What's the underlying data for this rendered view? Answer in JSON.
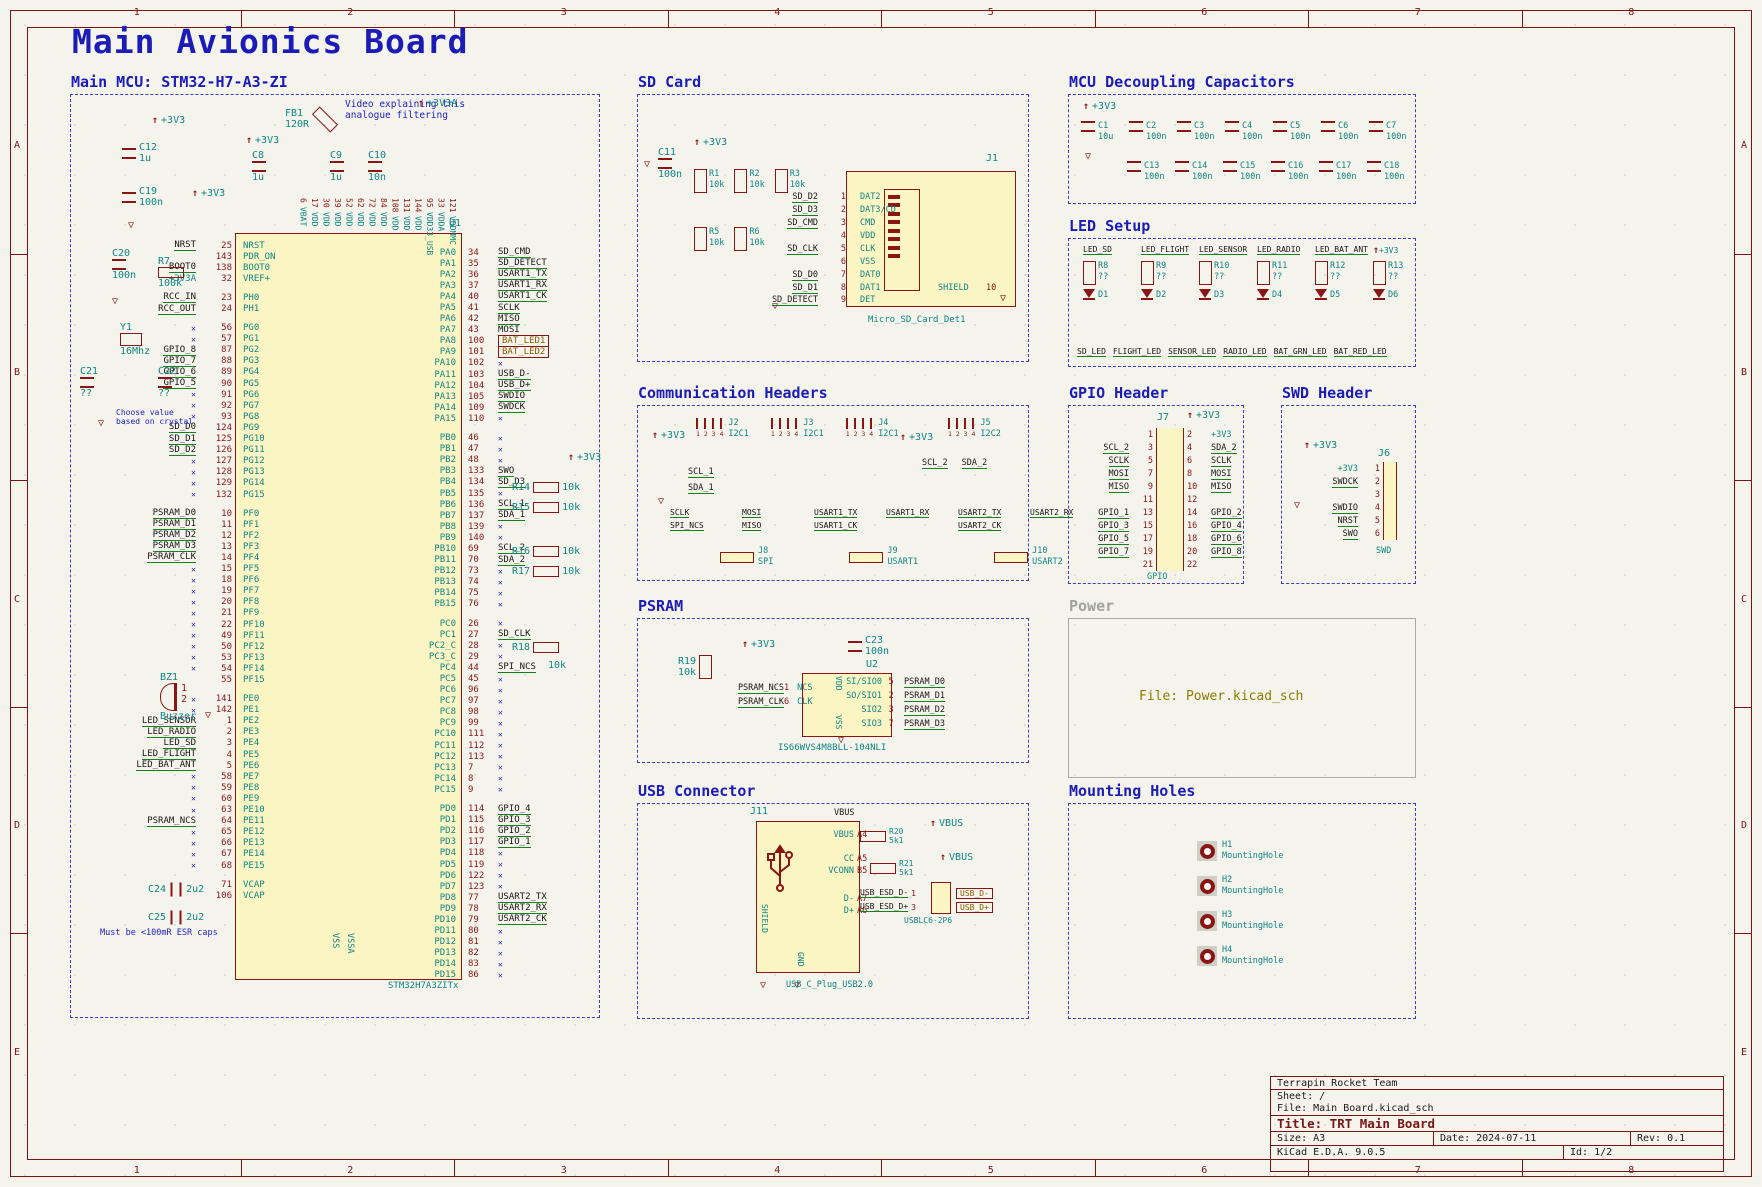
{
  "sheet": {
    "title": "Main Avionics Board",
    "cols": [
      "1",
      "2",
      "3",
      "4",
      "5",
      "6",
      "7",
      "8"
    ],
    "rows": [
      "A",
      "B",
      "C",
      "D",
      "E"
    ]
  },
  "title_block": {
    "company": "Terrapin Rocket Team",
    "sheet_label": "Sheet: /",
    "file_label": "File: Main Board.kicad_sch",
    "title_label": "Title: TRT Main Board",
    "size_label": "Size: A3",
    "date_label": "Date: 2024-07-11",
    "rev_label": "Rev: 0.1",
    "tool_label": "KiCad E.D.A. 9.0.5",
    "id_label": "Id: 1/2"
  },
  "colors": {
    "accent_blue": "#1b1bb8",
    "wire_green": "#178017",
    "pin_red": "#8a1515",
    "teal": "#0e8585",
    "hier_olive": "#8a5c00",
    "body_yellow": "#fbf5c4"
  },
  "mcu": {
    "title": "Main MCU: STM32-H7-A3-ZI",
    "ref": "U1",
    "part": "STM32H7A3ZITx",
    "bottom_left": "VSS",
    "bottom_right": "VSSA",
    "top_pins": [
      [
        "6",
        "VBAT"
      ],
      [
        "17",
        "VDD"
      ],
      [
        "30",
        "VDD"
      ],
      [
        "39",
        "VDD"
      ],
      [
        "52",
        "VDD"
      ],
      [
        "62",
        "VDD"
      ],
      [
        "72",
        "VDD"
      ],
      [
        "84",
        "VDD"
      ],
      [
        "108",
        "VDD"
      ],
      [
        "131",
        "VDD"
      ],
      [
        "144",
        "VDD"
      ],
      [
        "95",
        "VDD33_USB"
      ],
      [
        "33",
        "VDDA"
      ],
      [
        "121",
        "VDDMMC"
      ]
    ],
    "left_pins": [
      [
        "NRST",
        "25",
        "NRST",
        "n"
      ],
      [
        "",
        "143",
        "PDR_ON",
        ""
      ],
      [
        "BOOT0",
        "138",
        "BOOT0",
        "n"
      ],
      [
        "+3V3A",
        "32",
        "VREF+",
        "p"
      ],
      [
        "-"
      ],
      [
        "RCC_IN",
        "23",
        "PH0",
        "n"
      ],
      [
        "RCC_OUT",
        "24",
        "PH1",
        "n"
      ],
      [
        "-"
      ],
      [
        "",
        "56",
        "PG0",
        "x"
      ],
      [
        "",
        "57",
        "PG1",
        "x"
      ],
      [
        "GPIO_8",
        "87",
        "PG2",
        "n"
      ],
      [
        "GPIO_7",
        "88",
        "PG3",
        "n"
      ],
      [
        "GPIO_6",
        "89",
        "PG4",
        "n"
      ],
      [
        "GPIO_5",
        "90",
        "PG5",
        "n"
      ],
      [
        "",
        "91",
        "PG6",
        "x"
      ],
      [
        "",
        "92",
        "PG7",
        "x"
      ],
      [
        "",
        "93",
        "PG8",
        "x"
      ],
      [
        "SD_D0",
        "124",
        "PG9",
        "n"
      ],
      [
        "SD_D1",
        "125",
        "PG10",
        "n"
      ],
      [
        "SD_D2",
        "126",
        "PG11",
        "n"
      ],
      [
        "",
        "127",
        "PG12",
        "x"
      ],
      [
        "",
        "128",
        "PG13",
        "x"
      ],
      [
        "",
        "129",
        "PG14",
        "x"
      ],
      [
        "",
        "132",
        "PG15",
        "x"
      ],
      [
        "-"
      ],
      [
        "PSRAM_D0",
        "10",
        "PF0",
        "n"
      ],
      [
        "PSRAM_D1",
        "11",
        "PF1",
        "n"
      ],
      [
        "PSRAM_D2",
        "12",
        "PF2",
        "n"
      ],
      [
        "PSRAM_D3",
        "13",
        "PF3",
        "n"
      ],
      [
        "PSRAM_CLK",
        "14",
        "PF4",
        "n"
      ],
      [
        "",
        "15",
        "PF5",
        "x"
      ],
      [
        "",
        "18",
        "PF6",
        "x"
      ],
      [
        "",
        "19",
        "PF7",
        "x"
      ],
      [
        "",
        "20",
        "PF8",
        "x"
      ],
      [
        "",
        "21",
        "PF9",
        "x"
      ],
      [
        "",
        "22",
        "PF10",
        "x"
      ],
      [
        "",
        "49",
        "PF11",
        "x"
      ],
      [
        "",
        "50",
        "PF12",
        "x"
      ],
      [
        "",
        "53",
        "PF13",
        "x"
      ],
      [
        "",
        "54",
        "PF14",
        "x"
      ],
      [
        "",
        "55",
        "PF15",
        ""
      ],
      [
        "-"
      ],
      [
        "",
        "141",
        "PE0",
        "x"
      ],
      [
        "",
        "142",
        "PE1",
        "x"
      ],
      [
        "LED_SENSOR",
        "1",
        "PE2",
        "n"
      ],
      [
        "LED_RADIO",
        "2",
        "PE3",
        "n"
      ],
      [
        "LED_SD",
        "3",
        "PE4",
        "n"
      ],
      [
        "LED_FLIGHT",
        "4",
        "PE5",
        "n"
      ],
      [
        "LED_BAT_ANT",
        "5",
        "PE6",
        "n"
      ],
      [
        "",
        "58",
        "PE7",
        "x"
      ],
      [
        "",
        "59",
        "PE8",
        "x"
      ],
      [
        "",
        "60",
        "PE9",
        "x"
      ],
      [
        "",
        "63",
        "PE10",
        "x"
      ],
      [
        "PSRAM_NCS",
        "64",
        "PE11",
        "n"
      ],
      [
        "",
        "65",
        "PE12",
        "x"
      ],
      [
        "",
        "66",
        "PE13",
        "x"
      ],
      [
        "",
        "67",
        "PE14",
        "x"
      ],
      [
        "",
        "68",
        "PE15",
        "x"
      ],
      [
        "-"
      ],
      [
        "",
        "71",
        "VCAP",
        ""
      ],
      [
        "",
        "106",
        "VCAP",
        ""
      ]
    ],
    "right_pins": [
      [
        "PA0",
        "34",
        "SD_CMD",
        "n"
      ],
      [
        "PA1",
        "35",
        "SD_DETECT",
        "n"
      ],
      [
        "PA2",
        "36",
        "USART1_TX",
        "n"
      ],
      [
        "PA3",
        "37",
        "USART1_RX",
        "n"
      ],
      [
        "PA4",
        "40",
        "USART1_CK",
        "n"
      ],
      [
        "PA5",
        "41",
        "SCLK",
        "n"
      ],
      [
        "PA6",
        "42",
        "MISO",
        "n"
      ],
      [
        "PA7",
        "43",
        "MOSI",
        "n"
      ],
      [
        "PA8",
        "100",
        "BAT_LED1",
        "h"
      ],
      [
        "PA9",
        "101",
        "BAT_LED2",
        "h"
      ],
      [
        "PA10",
        "102",
        "",
        "x"
      ],
      [
        "PA11",
        "103",
        "USB_D-",
        "n"
      ],
      [
        "PA12",
        "104",
        "USB_D+",
        "n"
      ],
      [
        "PA13",
        "105",
        "SWDIO",
        "n"
      ],
      [
        "PA14",
        "109",
        "SWDCK",
        "n"
      ],
      [
        "PA15",
        "110",
        "",
        "x"
      ],
      [
        "-"
      ],
      [
        "PB0",
        "46",
        "",
        "x"
      ],
      [
        "PB1",
        "47",
        "",
        "x"
      ],
      [
        "PB2",
        "48",
        "",
        "x"
      ],
      [
        "PB3",
        "133",
        "SWO",
        "n"
      ],
      [
        "PB4",
        "134",
        "SD_D3",
        "n"
      ],
      [
        "PB5",
        "135",
        "",
        "x"
      ],
      [
        "PB6",
        "136",
        "SCL_1",
        "n"
      ],
      [
        "PB7",
        "137",
        "SDA_1",
        "n"
      ],
      [
        "PB8",
        "139",
        "",
        "x"
      ],
      [
        "PB9",
        "140",
        "",
        "x"
      ],
      [
        "PB10",
        "69",
        "SCL_2",
        "n"
      ],
      [
        "PB11",
        "70",
        "SDA_2",
        "n"
      ],
      [
        "PB12",
        "73",
        "",
        "x"
      ],
      [
        "PB13",
        "74",
        "",
        "x"
      ],
      [
        "PB14",
        "75",
        "",
        "x"
      ],
      [
        "PB15",
        "76",
        "",
        "x"
      ],
      [
        "-"
      ],
      [
        "PC0",
        "26",
        "",
        "x"
      ],
      [
        "PC1",
        "27",
        "SD_CLK",
        "n"
      ],
      [
        "PC2_C",
        "28",
        "",
        "x"
      ],
      [
        "PC3_C",
        "29",
        "",
        "x"
      ],
      [
        "PC4",
        "44",
        "SPI_NCS",
        "n"
      ],
      [
        "PC5",
        "45",
        "",
        "x"
      ],
      [
        "PC6",
        "96",
        "",
        "x"
      ],
      [
        "PC7",
        "97",
        "",
        "x"
      ],
      [
        "PC8",
        "98",
        "",
        "x"
      ],
      [
        "PC9",
        "99",
        "",
        "x"
      ],
      [
        "PC10",
        "111",
        "",
        "x"
      ],
      [
        "PC11",
        "112",
        "",
        "x"
      ],
      [
        "PC12",
        "113",
        "",
        "x"
      ],
      [
        "PC13",
        "7",
        "",
        "x"
      ],
      [
        "PC14",
        "8",
        "",
        "x"
      ],
      [
        "PC15",
        "9",
        "",
        "x"
      ],
      [
        "-"
      ],
      [
        "PD0",
        "114",
        "GPIO_4",
        "n"
      ],
      [
        "PD1",
        "115",
        "GPIO_3",
        "n"
      ],
      [
        "PD2",
        "116",
        "GPIO_2",
        "n"
      ],
      [
        "PD3",
        "117",
        "GPIO_1",
        "n"
      ],
      [
        "PD4",
        "118",
        "",
        "x"
      ],
      [
        "PD5",
        "119",
        "",
        "x"
      ],
      [
        "PD6",
        "122",
        "",
        "x"
      ],
      [
        "PD7",
        "123",
        "",
        "x"
      ],
      [
        "PD8",
        "77",
        "USART2_TX",
        "n"
      ],
      [
        "PD9",
        "78",
        "USART2_RX",
        "n"
      ],
      [
        "PD10",
        "79",
        "USART2_CK",
        "n"
      ],
      [
        "PD11",
        "80",
        "",
        "x"
      ],
      [
        "PD12",
        "81",
        "",
        "x"
      ],
      [
        "PD13",
        "82",
        "",
        "x"
      ],
      [
        "PD14",
        "83",
        "",
        "x"
      ],
      [
        "PD15",
        "86",
        "",
        "x"
      ]
    ],
    "pullups": {
      "power": "+3V3",
      "rows": [
        [
          "R14",
          "10k"
        ],
        [
          "R15",
          "10k"
        ],
        [
          "R16",
          "10k"
        ],
        [
          "R17",
          "10k"
        ]
      ],
      "r18_ref": "R18",
      "r18_val": "10k"
    },
    "ann": {
      "pwr_3v3": "+3V3",
      "pwr_3v3a": "+3V3A",
      "c12_ref": "C12",
      "c12_val": "1u",
      "c19_ref": "C19",
      "c19_val": "100n",
      "c8_ref": "C8",
      "c8_val": "1u",
      "fb1_ref": "FB1",
      "fb1_val": "120R",
      "c9_ref": "C9",
      "c9_val": "1u",
      "c10_ref": "C10",
      "c10_val": "10n",
      "note_filter": "Video explaining this\nanalogue filtering",
      "c20_ref": "C20",
      "c20_val": "100n",
      "r7_ref": "R7",
      "r7_val": "100k",
      "y1_ref": "Y1",
      "y1_val": "16Mhz",
      "c21_ref": "C21",
      "c21_val": "??",
      "c22_ref": "C22",
      "c22_val": "??",
      "note_xtal": "Choose value\nbased on crystal",
      "bz_ref": "BZ1",
      "bz_val": "Buzzer",
      "bz_p1": "1",
      "bz_p2": "2",
      "c24_ref": "C24",
      "c24_val": "2u2",
      "c25_ref": "C25",
      "c25_val": "2u2",
      "note_esr": "Must be <100mR ESR caps"
    }
  },
  "sd": {
    "title": "SD Card",
    "ref": "J1",
    "part": "Micro_SD_Card_Det1",
    "c11_ref": "C11",
    "c11_val": "100n",
    "p3v3": "+3V3",
    "res_top": [
      [
        "R1",
        "10k"
      ],
      [
        "R2",
        "10k"
      ],
      [
        "R3",
        "10k"
      ]
    ],
    "res_bot": [
      [
        "R5",
        "10k"
      ],
      [
        "R6",
        "10k"
      ]
    ],
    "rows": [
      [
        "SD_D2",
        "1",
        "DAT2"
      ],
      [
        "SD_D3",
        "2",
        "DAT3/CD"
      ],
      [
        "SD_CMD",
        "3",
        "CMD"
      ],
      [
        "",
        "4",
        "VDD"
      ],
      [
        "SD_CLK",
        "5",
        "CLK"
      ],
      [
        "",
        "6",
        "VSS"
      ],
      [
        "SD_D0",
        "7",
        "DAT0"
      ],
      [
        "SD_D1",
        "8",
        "DAT1"
      ]
    ],
    "det": [
      "SD_DETECT",
      "9",
      "DET"
    ],
    "shield_name": "SHIELD",
    "shield_num": "10"
  },
  "decap": {
    "title": "MCU Decoupling Capacitors",
    "p3v3": "+3V3",
    "row1": [
      [
        "C1",
        "10u"
      ],
      [
        "C2",
        "100n"
      ],
      [
        "C3",
        "100n"
      ],
      [
        "C4",
        "100n"
      ],
      [
        "C5",
        "100n"
      ],
      [
        "C6",
        "100n"
      ],
      [
        "C7",
        "100n"
      ]
    ],
    "row2": [
      [
        "C13",
        "100n"
      ],
      [
        "C14",
        "100n"
      ],
      [
        "C15",
        "100n"
      ],
      [
        "C16",
        "100n"
      ],
      [
        "C17",
        "100n"
      ],
      [
        "C18",
        "100n"
      ]
    ]
  },
  "led": {
    "title": "LED Setup",
    "p3v3": "+3V3",
    "inputs": [
      "LED_SD",
      "LED_FLIGHT",
      "LED_SENSOR",
      "LED_RADIO",
      "LED_BAT_ANT",
      "+3V3"
    ],
    "resistors": [
      [
        "R8",
        "??"
      ],
      [
        "R9",
        "??"
      ],
      [
        "R10",
        "??"
      ],
      [
        "R11",
        "??"
      ],
      [
        "R12",
        "??"
      ],
      [
        "R13",
        "??"
      ]
    ],
    "diodes": [
      "D1",
      "D2",
      "D3",
      "D4",
      "D5",
      "D6"
    ],
    "outputs": [
      "SD_LED",
      "FLIGHT_LED",
      "SENSOR_LED",
      "RADIO_LED",
      "BAT_GRN_LED",
      "BAT_RED_LED"
    ]
  },
  "comm": {
    "title": "Communication Headers",
    "p3v3": "+3V3",
    "i2c1_headers": [
      [
        "J2",
        "I2C1"
      ],
      [
        "J3",
        "I2C1"
      ],
      [
        "J4",
        "I2C1"
      ]
    ],
    "i2c2_header": [
      "J5",
      "I2C2"
    ],
    "pin_nums": "1 2 3 4",
    "i2c1_nets": [
      "SCL_1",
      "SDA_1"
    ],
    "i2c2_nets": [
      "SCL_2",
      "SDA_2"
    ],
    "pairs": [
      [
        "SCLK",
        "SPI_NCS"
      ],
      [
        "MOSI",
        "MISO"
      ],
      [
        "USART1_TX",
        "USART1_CK"
      ],
      [
        "USART1_RX",
        ""
      ],
      [
        "USART2_TX",
        "USART2_CK"
      ],
      [
        "USART2_RX",
        ""
      ]
    ],
    "bottom_headers": [
      [
        "J8",
        "SPI"
      ],
      [
        "J9",
        "USART1"
      ],
      [
        "J10",
        "USART2"
      ]
    ]
  },
  "gpio": {
    "title": "GPIO Header",
    "ref": "J7",
    "label": "GPIO",
    "p3v3": "+3V3",
    "rows": [
      [
        "",
        "1",
        "2",
        "+3V3"
      ],
      [
        "SCL_2",
        "3",
        "4",
        "SDA_2"
      ],
      [
        "SCLK",
        "5",
        "6",
        "SCLK"
      ],
      [
        "MOSI",
        "7",
        "8",
        "MOSI"
      ],
      [
        "MISO",
        "9",
        "10",
        "MISO"
      ],
      [
        "",
        "11",
        "12",
        ""
      ],
      [
        "GPIO_1",
        "13",
        "14",
        "GPIO_2"
      ],
      [
        "GPIO_3",
        "15",
        "16",
        "GPIO_4"
      ],
      [
        "GPIO_5",
        "17",
        "18",
        "GPIO_6"
      ],
      [
        "GPIO_7",
        "19",
        "20",
        "GPIO_8"
      ],
      [
        "",
        "21",
        "22",
        ""
      ]
    ]
  },
  "swd": {
    "title": "SWD Header",
    "ref": "J6",
    "label": "SWD",
    "p3v3": "+3V3",
    "rows": [
      [
        "+3V3",
        "1"
      ],
      [
        "SWDCK",
        "2"
      ],
      [
        "",
        "3"
      ],
      [
        "SWDIO",
        "4"
      ],
      [
        "NRST",
        "5"
      ],
      [
        "SWO",
        "6"
      ]
    ]
  },
  "psram": {
    "title": "PSRAM",
    "ref": "U2",
    "part": "IS66WVS4M8BLL-104NLI",
    "r19_ref": "R19",
    "r19_val": "10k",
    "c23_ref": "C23",
    "c23_val": "100n",
    "p3v3": "+3V3",
    "vdd": "VDD",
    "vss": "VSS",
    "left_rows": [
      [
        "PSRAM_NCS",
        "1",
        "NCS"
      ],
      [
        "PSRAM_CLK",
        "6",
        "CLK"
      ]
    ],
    "right_rows": [
      [
        "5",
        "SI/SIO0",
        "PSRAM_D0"
      ],
      [
        "2",
        "SO/SIO1",
        "PSRAM_D1"
      ],
      [
        "3",
        "SIO2",
        "PSRAM_D2"
      ],
      [
        "7",
        "SIO3",
        "PSRAM_D3"
      ]
    ]
  },
  "power_sheet": {
    "title": "Power",
    "file": "File: Power.kicad_sch"
  },
  "usb": {
    "title": "USB Connector",
    "ref": "J11",
    "part": "USB_C_Plug_USB2.0",
    "vbus_net": "VBUS",
    "vbus_pwr": "VBUS",
    "r20_ref": "R20",
    "r20_val": "5k1",
    "r21_ref": "R21",
    "r21_val": "5k1",
    "shield": "SHIELD",
    "gnd": "GND",
    "pins": [
      [
        "VBUS",
        "A4"
      ],
      [
        "CC",
        "A5"
      ],
      [
        "VCONN",
        "B5"
      ],
      [
        "D-",
        "A7"
      ],
      [
        "D+",
        "A6"
      ]
    ],
    "esd_nets": [
      [
        "USB_ESD_D-",
        "1"
      ],
      [
        "USB_ESD_D+",
        "3"
      ]
    ],
    "esd_part": "USBLC6-2P6",
    "out_nets": [
      "USB_D-",
      "USB_D+"
    ]
  },
  "mount": {
    "title": "Mounting Holes",
    "holes": [
      [
        "H1",
        "MountingHole"
      ],
      [
        "H2",
        "MountingHole"
      ],
      [
        "H3",
        "MountingHole"
      ],
      [
        "H4",
        "MountingHole"
      ]
    ]
  }
}
